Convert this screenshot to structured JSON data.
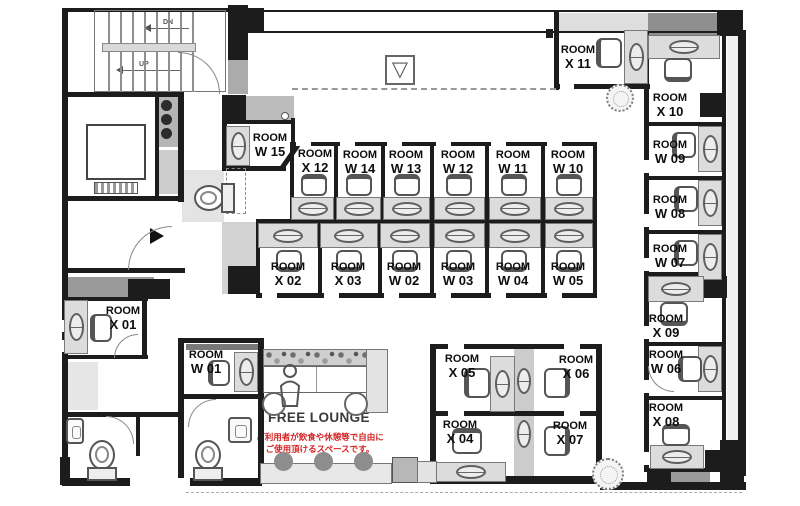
{
  "plan": {
    "room_prefix": "ROOM",
    "free_lounge_title": "FREE LOUNGE",
    "lounge_note_line1": "ご利用者が飲食や休憩等で自由に",
    "lounge_note_line2": "ご使用頂けるスペースです。",
    "stairs_up": "UP",
    "stairs_down": "DN",
    "hatch_symbol": "▽"
  },
  "rooms": {
    "x01": "X 01",
    "x02": "X 02",
    "x03": "X 03",
    "x04": "X 04",
    "x05": "X 05",
    "x06": "X 06",
    "x07": "X 07",
    "x08": "X 08",
    "x09": "X 09",
    "x10": "X 10",
    "x11": "X 11",
    "x12": "X 12",
    "w01": "W 01",
    "w02": "W 02",
    "w03": "W 03",
    "w04": "W 04",
    "w05": "W 05",
    "w06": "W 06",
    "w07": "W 07",
    "w08": "W 08",
    "w09": "W 09",
    "w10": "W 10",
    "w11": "W 11",
    "w12": "W 12",
    "w13": "W 13",
    "w14": "W 14",
    "w15": "W 15"
  },
  "colors": {
    "wall": "#1c1c1c",
    "note_red": "#d62323",
    "desk_fill": "#dcdcdc",
    "shade_dark": "#8f8f8f"
  }
}
